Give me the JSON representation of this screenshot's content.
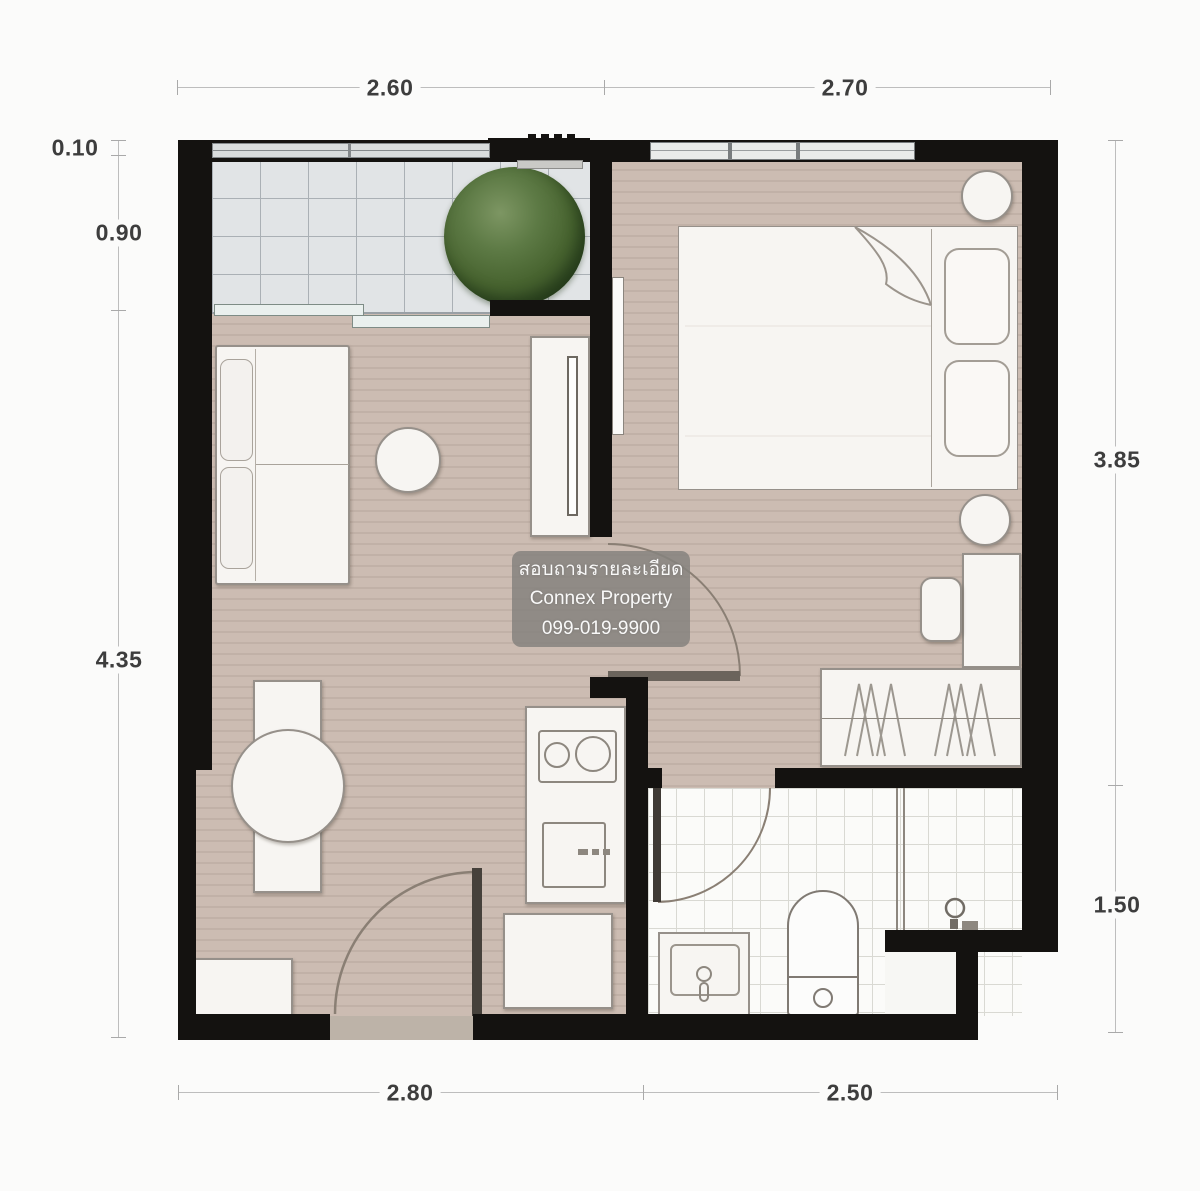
{
  "watermark": {
    "lines": [
      "สอบถามรายละเอียด",
      "Connex Property",
      "099-019-9900"
    ]
  },
  "dimensions": {
    "top": [
      {
        "label": "2.60"
      },
      {
        "label": "2.70"
      }
    ],
    "bottom": [
      {
        "label": "2.80"
      },
      {
        "label": "2.50"
      }
    ],
    "left": [
      {
        "label": "0.10"
      },
      {
        "label": "0.90"
      },
      {
        "label": "4.35"
      }
    ],
    "right": [
      {
        "label": "3.85"
      },
      {
        "label": "1.50"
      }
    ]
  },
  "colors": {
    "wall": "#141210",
    "wood_floor": "#c8b8ae",
    "balcony_tile": "#e1e4e6",
    "bathroom_tile": "#fbfbf9",
    "furniture": "#f7f5f2",
    "furniture_border": "#96908a",
    "plant_green": "#47632f",
    "dimension_text": "#3d3d3d",
    "watermark_bg": "rgba(133,130,126,0.85)",
    "watermark_text": "#ffffff",
    "door_threshold": "#bdb3a8"
  }
}
